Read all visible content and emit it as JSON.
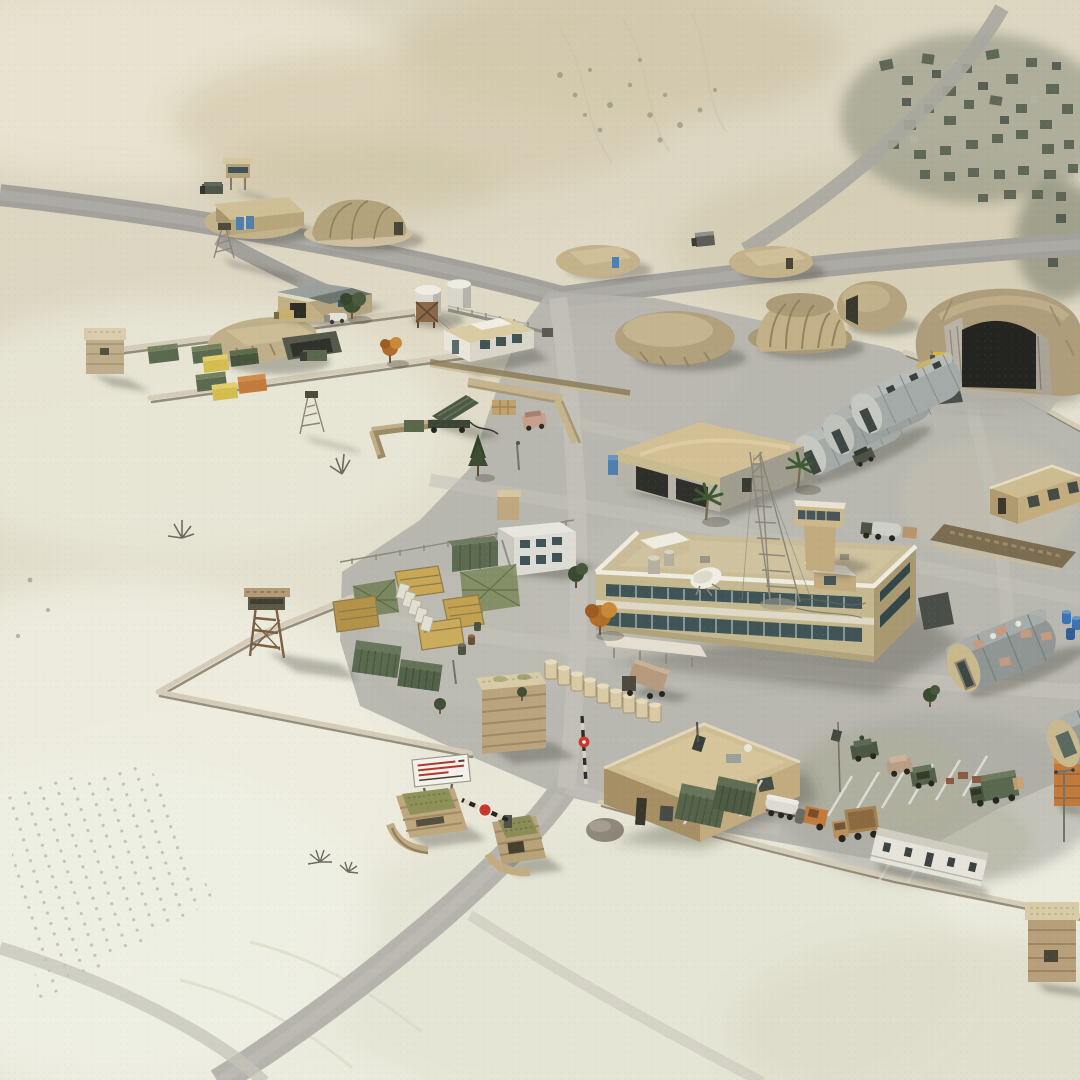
{
  "scene": {
    "title": "Desert Military Base — 3D Aerial Render",
    "description": "Isometric aerial 3D render of a desert forward operating base: a road runs past walled compounds with shipping containers, earth-covered hangars and bermed tents, rows of quonset huts, a two-storey headquarters with rooftop radio tower and satellite dish, supply yards, a missile emplacement, guard towers, a vehicle motor pool and an entry checkpoint with a striped barrier and warning sign. A ruined village lies to the north-east.",
    "view": "aerial-oblique",
    "environment": "desert",
    "time_of_day": "midday"
  },
  "palette": {
    "sand_light": "#e7e3d2",
    "sand_pale": "#edecdf",
    "sand_mid": "#d8cfb5",
    "sand_dark": "#c9bd9d",
    "asphalt": "#a3a19b",
    "asphalt_light": "#b8b6af",
    "apron": "#b4b3ac",
    "concrete": "#c6c4bb",
    "wall": "#d4ccb8",
    "wall_shadow": "#7e7766",
    "building_tan": "#c5b88f",
    "building_tan_dark": "#a89970",
    "roof_tan": "#cfbe93",
    "white_trim": "#eeebe0",
    "quonset_gray": "#a4aaa7",
    "quonset_dark": "#6e7675",
    "earth_mound": "#b0a17f",
    "earth_dark": "#837659",
    "container_green": "#5a6a4e",
    "container_green_dark": "#46543c",
    "container_yellow": "#d3bd4e",
    "container_orange": "#c27a3d",
    "tree_green": "#3e4f33",
    "tree_autumn": "#b26d2a",
    "blue_accent": "#4f7fae",
    "red_accent": "#c43b2e",
    "window_dark": "#3f5456",
    "village": "#5f6757"
  },
  "objects": [
    {
      "id": "main-road",
      "label": "Main road running past the base"
    },
    {
      "id": "village-ruins",
      "label": "Distant village and orchard blocks (north-east)"
    },
    {
      "id": "storage-yard",
      "label": "Walled storage yard with shipping containers and earth-covered bunker"
    },
    {
      "id": "corner-sandbag-tower",
      "label": "Sandbag corner tower of storage yard"
    },
    {
      "id": "warehouse",
      "label": "Metal-roof warehouse shed"
    },
    {
      "id": "water-tanks",
      "label": "Twin white storage tanks with pipeline"
    },
    {
      "id": "utility-building",
      "label": "White utility building"
    },
    {
      "id": "frame-tent",
      "label": "Frame tent with blue doors"
    },
    {
      "id": "dome-tent",
      "label": "Ribbed dome tent"
    },
    {
      "id": "nw-watchtower",
      "label": "Small watchtower"
    },
    {
      "id": "nw-lattice-tower",
      "label": "Lattice mast"
    },
    {
      "id": "berm-tent-west",
      "label": "Earth-bermed tent (west)"
    },
    {
      "id": "berm-tent-east",
      "label": "Earth-bermed tent (east)"
    },
    {
      "id": "road-vehicle",
      "label": "Vehicle driving on the road"
    },
    {
      "id": "earth-mound",
      "label": "Spoil mound"
    },
    {
      "id": "pleated-shelter",
      "label": "Pleated fabric shelter with earth berm"
    },
    {
      "id": "earth-dome",
      "label": "Earth-covered dome shelter"
    },
    {
      "id": "hardened-hangar",
      "label": "Earth-covered hardened shelter with concrete portal"
    },
    {
      "id": "quonset-row",
      "label": "Row of three corrugated quonset huts"
    },
    {
      "id": "maintenance-garage",
      "label": "Maintenance garage with curved tan roof"
    },
    {
      "id": "portable-toilet",
      "label": "Blue portable toilet"
    },
    {
      "id": "missile-launcher",
      "label": "Raised missile launcher emplacement"
    },
    {
      "id": "hesco-barriers",
      "label": "Hesco barrier rows"
    },
    {
      "id": "barracks",
      "label": "Two-storey containerized barracks"
    },
    {
      "id": "supply-yard",
      "label": "Supply yard with covered pallet stacks and camouflage nets"
    },
    {
      "id": "concrete-barrier-row",
      "label": "Row of white concrete barriers"
    },
    {
      "id": "green-containers",
      "label": "Olive-green shipping containers"
    },
    {
      "id": "hq-building",
      "label": "Two-storey headquarters building"
    },
    {
      "id": "radio-tower",
      "label": "Lattice radio tower on HQ roof"
    },
    {
      "id": "satellite-dish",
      "label": "Rooftop satellite dish"
    },
    {
      "id": "control-tower",
      "label": "Observation tower behind HQ"
    },
    {
      "id": "barrier-cylinder-row",
      "label": "Row of cylindrical barriers"
    },
    {
      "id": "cargo-truck",
      "label": "Cargo truck"
    },
    {
      "id": "tanker-truck",
      "label": "Tanker truck"
    },
    {
      "id": "west-guard-tower",
      "label": "Wooden guard tower on perimeter wall"
    },
    {
      "id": "perimeter-wall",
      "label": "Base perimeter wall"
    },
    {
      "id": "gate-sandbag-tower",
      "label": "Large sandbag tower at the gate"
    },
    {
      "id": "checkpoint",
      "label": "Entry checkpoint with lowered striped barrier"
    },
    {
      "id": "checkpoint-sign",
      "label": "White warning sign (text illegible)"
    },
    {
      "id": "checkpoint-bunker-west",
      "label": "Sandbag bunker with camouflaged roof (west)"
    },
    {
      "id": "checkpoint-bunker-median",
      "label": "Sandbag bunker with camouflaged roof (median)"
    },
    {
      "id": "guardhouse",
      "label": "Flat-roofed guardhouse"
    },
    {
      "id": "motor-pool",
      "label": "Motor pool with marked parking bays and military vehicles"
    },
    {
      "id": "trailer-office",
      "label": "White trailer building"
    },
    {
      "id": "fuel-tanker",
      "label": "White fuel tanker trailer"
    },
    {
      "id": "road-roller",
      "label": "Orange road roller"
    },
    {
      "id": "dump-truck",
      "label": "Tan dump truck"
    },
    {
      "id": "orange-container",
      "label": "Orange container with flood-light pole"
    },
    {
      "id": "se-quonset-huts",
      "label": "Quonset huts with sandbagged roofs (south-east)"
    },
    {
      "id": "blue-barrels",
      "label": "Blue barrels"
    },
    {
      "id": "east-building",
      "label": "Flat-roofed tan building with trench"
    },
    {
      "id": "se-sandbag-tower",
      "label": "Sandbag tower (south-east corner)"
    },
    {
      "id": "dead-vegetation",
      "label": "Dry desert shrubs and dead trees"
    },
    {
      "id": "palm-trees",
      "label": "Palm trees"
    }
  ]
}
